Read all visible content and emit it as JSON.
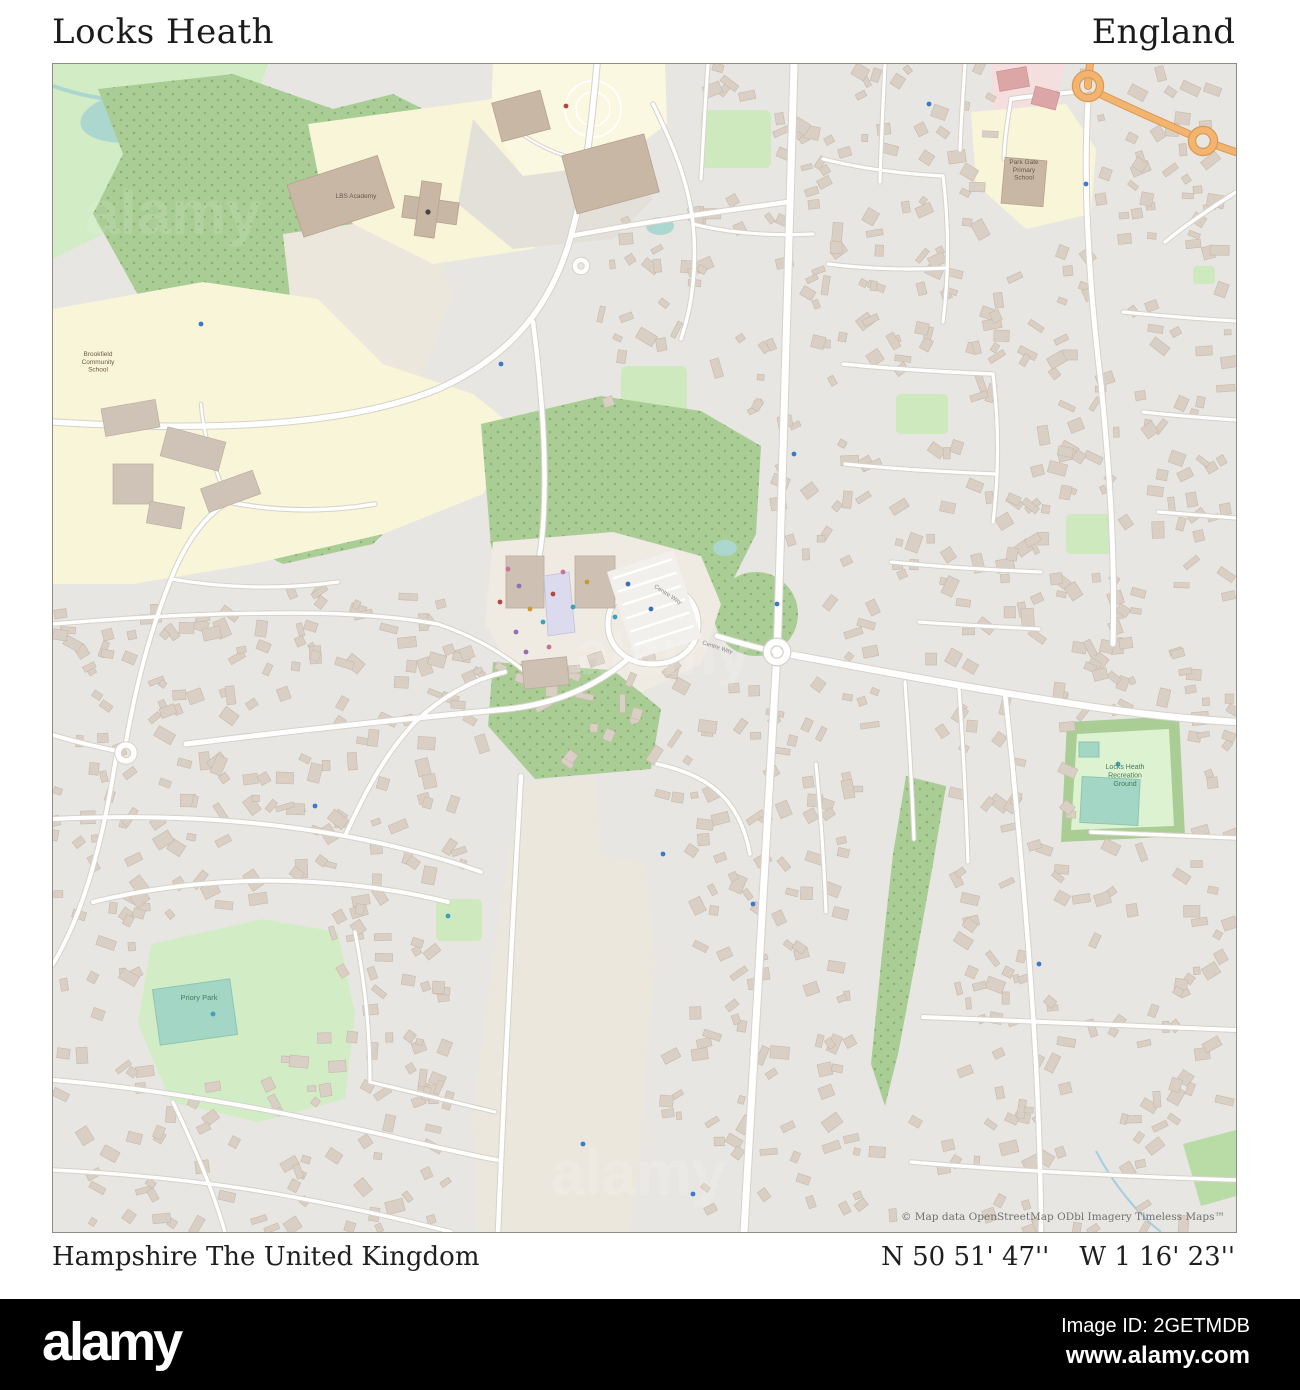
{
  "header": {
    "title": "Locks Heath",
    "region": "England"
  },
  "footer": {
    "location": "Hampshire The United Kingdom",
    "latitude": "N 50 51' 47''",
    "longitude": "W 1 16' 23''"
  },
  "alamy_bar": {
    "logo": "alamy",
    "image_id": "Image ID: 2GETMDB",
    "website": "www.alamy.com"
  },
  "map": {
    "attribution": "© Map data OpenStreetMap ODbl Imagery Timeless Maps™",
    "watermark": "alamy",
    "colors": {
      "residential_bg": "#e8e6e2",
      "building": "#d9cfc5",
      "building_outline": "#c7b9aa",
      "wood_green": "#a9cd94",
      "park_light_green": "#d2edc6",
      "rec_inner_green": "#dcf2d0",
      "school_cream": "#f8f5d8",
      "open_beige": "#ece7dd",
      "pitch_teal": "#a3d6c4",
      "water_teal": "#abd7cf",
      "road_white": "#ffffff",
      "road_casing": "#d6d2ca",
      "main_road_orange": "#f3b46f",
      "retail_pink": "#f5dede",
      "label_school": "#6b5a49",
      "label_park": "#4a7c59",
      "label_road": "#8a8a8a"
    },
    "labels": [
      {
        "lines": [
          "Brookfield",
          "Community",
          "School"
        ],
        "x": 45,
        "y": 292,
        "size": 6.5,
        "color": "#6b5a49",
        "rotate": 0
      },
      {
        "lines": [
          "LBS Academy"
        ],
        "x": 303,
        "y": 134,
        "size": 6.5,
        "color": "#6b5a49",
        "rotate": 0
      },
      {
        "lines": [
          "Park Gate",
          "Primary",
          "School"
        ],
        "x": 971,
        "y": 100,
        "size": 6.5,
        "color": "#6b5a49",
        "rotate": 0
      },
      {
        "lines": [
          "Locks Heath",
          "Recreation",
          "Ground"
        ],
        "x": 1072,
        "y": 705,
        "size": 7,
        "color": "#4a7c59",
        "rotate": 0
      },
      {
        "lines": [
          "Priory Park"
        ],
        "x": 146,
        "y": 936,
        "size": 7.5,
        "color": "#4a7c59",
        "rotate": 0
      },
      {
        "lines": [
          "Centre Way"
        ],
        "x": 614,
        "y": 532,
        "size": 6,
        "color": "#8a8a8a",
        "rotate": 33
      },
      {
        "lines": [
          "Centre Way"
        ],
        "x": 664,
        "y": 585,
        "size": 6,
        "color": "#8a8a8a",
        "rotate": 18
      }
    ],
    "poi_dots": [
      {
        "x": 455,
        "y": 505,
        "c": "#c8719f"
      },
      {
        "x": 466,
        "y": 522,
        "c": "#8e6fb8"
      },
      {
        "x": 477,
        "y": 545,
        "c": "#c99a2e"
      },
      {
        "x": 490,
        "y": 558,
        "c": "#3f9fbf"
      },
      {
        "x": 500,
        "y": 530,
        "c": "#b5473f"
      },
      {
        "x": 510,
        "y": 508,
        "c": "#c8719f"
      },
      {
        "x": 463,
        "y": 568,
        "c": "#8e6fb8"
      },
      {
        "x": 520,
        "y": 543,
        "c": "#3f9fbf"
      },
      {
        "x": 534,
        "y": 518,
        "c": "#c99a2e"
      },
      {
        "x": 447,
        "y": 538,
        "c": "#b5473f"
      },
      {
        "x": 473,
        "y": 588,
        "c": "#8e6fb8"
      },
      {
        "x": 496,
        "y": 583,
        "c": "#c8719f"
      },
      {
        "x": 575,
        "y": 520,
        "c": "#3d6fb5"
      },
      {
        "x": 598,
        "y": 545,
        "c": "#3d6fb5"
      },
      {
        "x": 562,
        "y": 553,
        "c": "#3f9fbf"
      },
      {
        "x": 513,
        "y": 42,
        "c": "#b5473f"
      },
      {
        "x": 741,
        "y": 390,
        "c": "#3d78c9"
      },
      {
        "x": 724,
        "y": 540,
        "c": "#3d78c9"
      },
      {
        "x": 700,
        "y": 840,
        "c": "#3d78c9"
      },
      {
        "x": 610,
        "y": 790,
        "c": "#3d78c9"
      },
      {
        "x": 448,
        "y": 300,
        "c": "#3d78c9"
      },
      {
        "x": 1033,
        "y": 120,
        "c": "#3d78c9"
      },
      {
        "x": 876,
        "y": 40,
        "c": "#3d78c9"
      },
      {
        "x": 530,
        "y": 1080,
        "c": "#3d78c9"
      },
      {
        "x": 986,
        "y": 900,
        "c": "#3d78c9"
      },
      {
        "x": 262,
        "y": 742,
        "c": "#3d78c9"
      },
      {
        "x": 148,
        "y": 260,
        "c": "#3d78c9"
      },
      {
        "x": 640,
        "y": 1130,
        "c": "#3d78c9"
      },
      {
        "x": 1065,
        "y": 700,
        "c": "#3f9fbf"
      },
      {
        "x": 160,
        "y": 950,
        "c": "#3f9fbf"
      },
      {
        "x": 395,
        "y": 852,
        "c": "#3f9fbf"
      }
    ]
  }
}
